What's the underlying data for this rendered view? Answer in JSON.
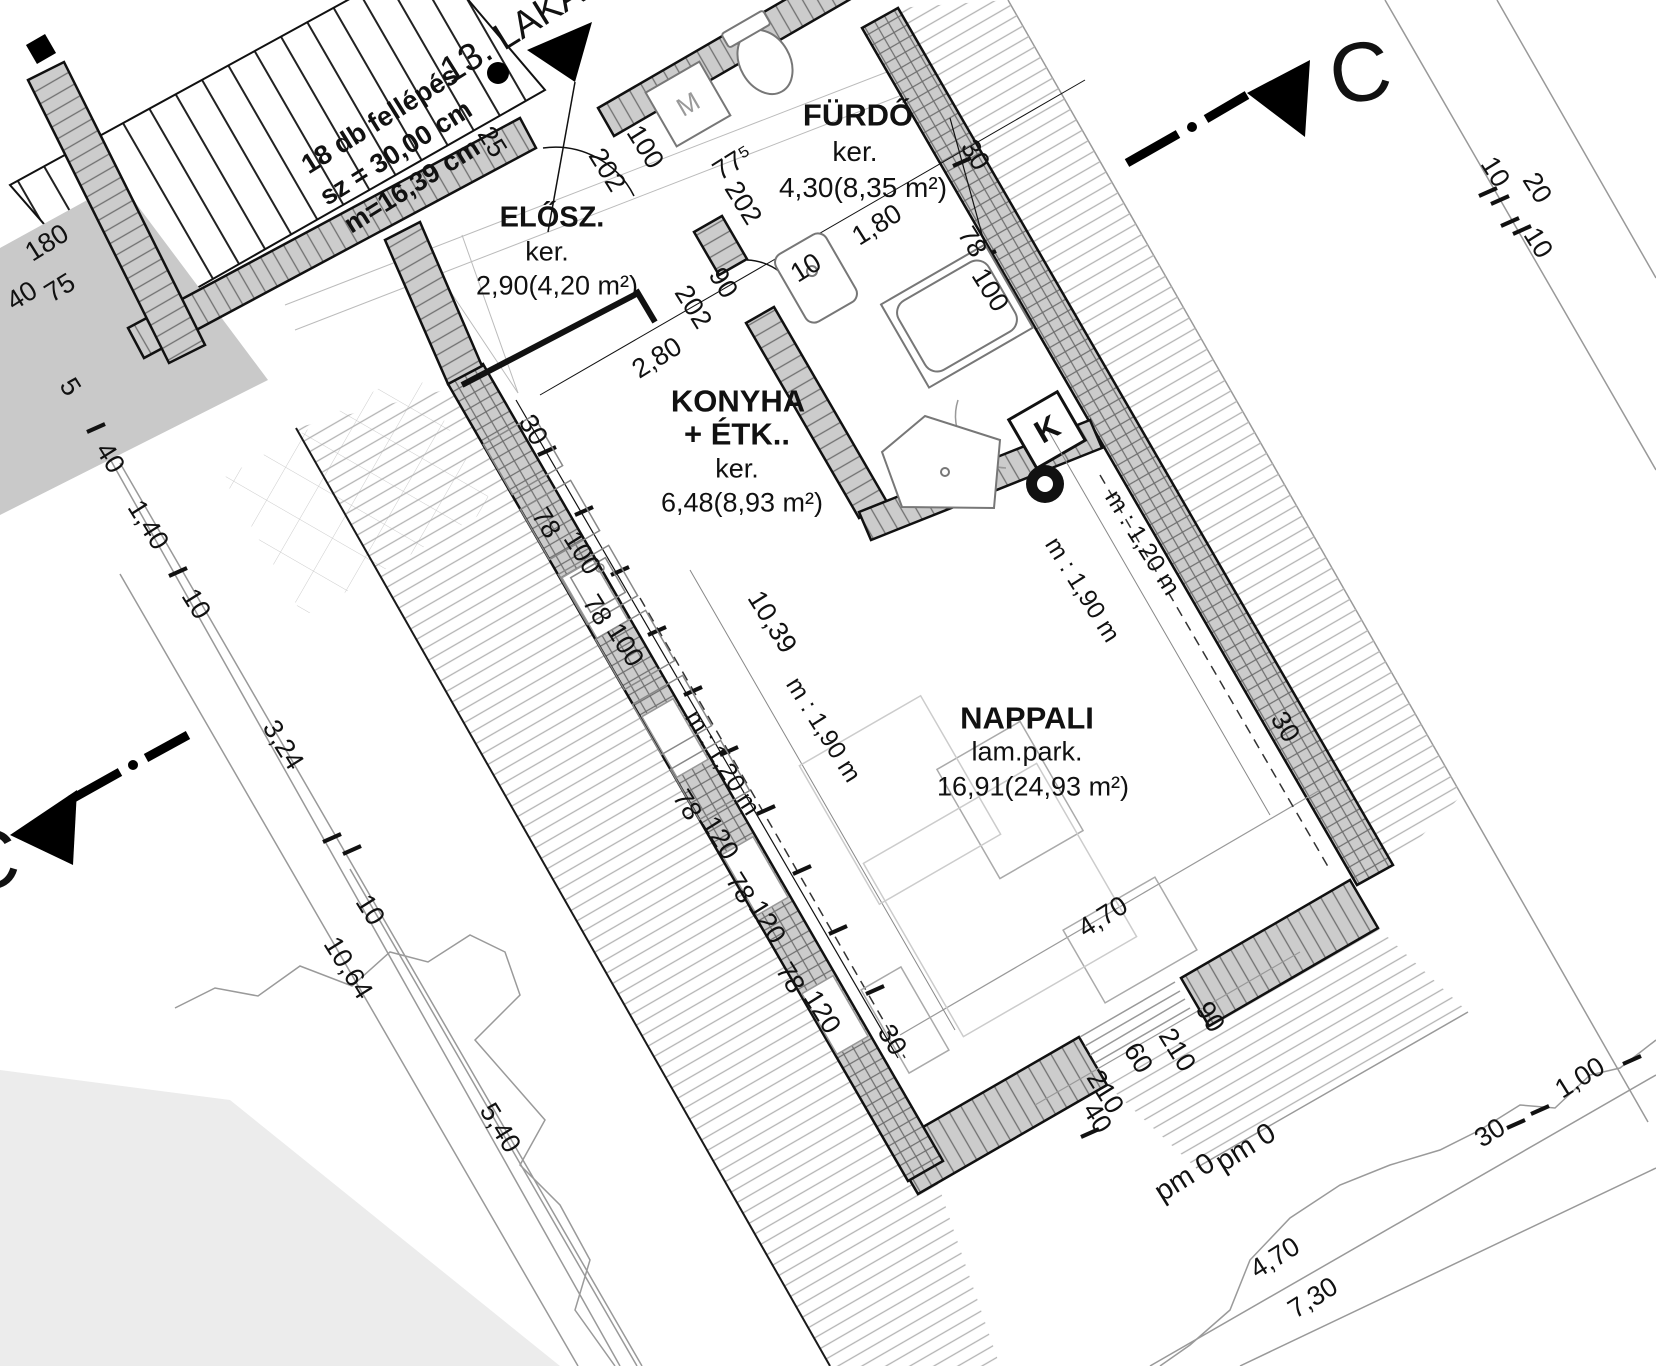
{
  "drawing": {
    "type_note": "attic apartment floor plan",
    "section_letter": "C"
  },
  "labels": {
    "room_labels": [
      {
        "name": "room-fuerdo-title",
        "text": "FÜRDŐ",
        "x": 858,
        "y": 115,
        "rot": 0,
        "size": 31,
        "bold": true
      },
      {
        "name": "room-fuerdo-finish",
        "text": "ker.",
        "x": 855,
        "y": 152,
        "rot": 0,
        "size": 28
      },
      {
        "name": "room-fuerdo-area",
        "text": "4,30(8,35 m²)",
        "x": 863,
        "y": 188,
        "rot": 0,
        "size": 28
      },
      {
        "name": "room-elosz-title",
        "text": "ELŐSZ.",
        "x": 552,
        "y": 218,
        "rot": 0,
        "size": 29,
        "bold": true
      },
      {
        "name": "room-elosz-finish",
        "text": "ker.",
        "x": 547,
        "y": 252,
        "rot": 0,
        "size": 27
      },
      {
        "name": "room-elosz-area",
        "text": "2,90(4,20 m²)",
        "x": 557,
        "y": 286,
        "rot": 0,
        "size": 27
      },
      {
        "name": "room-konyha-title-line1",
        "text": "KONYHA",
        "x": 738,
        "y": 401,
        "rot": 0,
        "size": 31,
        "bold": true
      },
      {
        "name": "room-konyha-title-line2",
        "text": "+ ÉTK..",
        "x": 737,
        "y": 434,
        "rot": 0,
        "size": 31,
        "bold": true
      },
      {
        "name": "room-konyha-finish",
        "text": "ker.",
        "x": 737,
        "y": 469,
        "rot": 0,
        "size": 27
      },
      {
        "name": "room-konyha-area",
        "text": "6,48(8,93 m²)",
        "x": 742,
        "y": 503,
        "rot": 0,
        "size": 27
      },
      {
        "name": "room-nappali-title",
        "text": "NAPPALI",
        "x": 1027,
        "y": 718,
        "rot": 0,
        "size": 31,
        "bold": true
      },
      {
        "name": "room-nappali-finish",
        "text": "lam.park.",
        "x": 1027,
        "y": 752,
        "rot": 0,
        "size": 27
      },
      {
        "name": "room-nappali-area",
        "text": "16,91(24,93 m²)",
        "x": 1033,
        "y": 787,
        "rot": 0,
        "size": 27
      }
    ],
    "annotation_labels": [
      {
        "name": "stair-note-line1",
        "text": "18 db fellépés",
        "x": 380,
        "y": 120,
        "rot": -32,
        "size": 27,
        "bold": true
      },
      {
        "name": "stair-note-line2",
        "text": "sz = 30,00 cm",
        "x": 396,
        "y": 153,
        "rot": -32,
        "size": 27,
        "bold": true
      },
      {
        "name": "stair-note-line3",
        "text": "m=16,39 cm",
        "x": 412,
        "y": 186,
        "rot": -32,
        "size": 27,
        "bold": true
      },
      {
        "name": "apartment-number",
        "text": "13. LAKÁ",
        "x": 512,
        "y": 32,
        "rot": -32,
        "size": 38
      },
      {
        "name": "washing-machine-letter",
        "text": "M",
        "x": 688,
        "y": 104,
        "rot": -30,
        "size": 26,
        "color": "#999999"
      },
      {
        "name": "chimney-letter",
        "text": "K",
        "x": 1047,
        "y": 429,
        "rot": -30,
        "size": 32,
        "bold": true
      },
      {
        "name": "headroom-120-left",
        "text": "m : 1,20 m",
        "x": 722,
        "y": 763,
        "rot": 58,
        "size": 25
      },
      {
        "name": "headroom-190-left",
        "text": "m : 1,90 m",
        "x": 823,
        "y": 730,
        "rot": 58,
        "size": 25
      },
      {
        "name": "headroom-120-right",
        "text": "m : 1,20 m",
        "x": 1142,
        "y": 543,
        "rot": 58,
        "size": 25
      },
      {
        "name": "headroom-190-right",
        "text": "m : 1,90 m",
        "x": 1082,
        "y": 590,
        "rot": 58,
        "size": 25
      },
      {
        "name": "level-mark-a",
        "text": "pm 0",
        "x": 1185,
        "y": 1178,
        "rot": -32,
        "size": 29
      },
      {
        "name": "level-mark-b",
        "text": "pm 0",
        "x": 1246,
        "y": 1148,
        "rot": -32,
        "size": 29
      }
    ],
    "marker_labels": [
      {
        "name": "section-letter-top-right",
        "text": "C",
        "x": 1360,
        "y": 72,
        "rot": -10,
        "size": 84
      },
      {
        "name": "section-letter-bottom-left",
        "text": "C",
        "x": -12,
        "y": 860,
        "rot": -10,
        "size": 84
      }
    ],
    "dimension_labels": [
      {
        "name": "dim-25",
        "text": "25",
        "x": 492,
        "y": 142,
        "rot": 58,
        "size": 27
      },
      {
        "name": "dim-202-a",
        "text": "202",
        "x": 607,
        "y": 170,
        "rot": 58,
        "size": 27
      },
      {
        "name": "dim-100-a",
        "text": "100",
        "x": 645,
        "y": 147,
        "rot": 58,
        "size": 27
      },
      {
        "name": "dim-202-b",
        "text": "202",
        "x": 743,
        "y": 203,
        "rot": 58,
        "size": 27
      },
      {
        "name": "dim-202-c",
        "text": "202",
        "x": 693,
        "y": 307,
        "rot": 58,
        "size": 27
      },
      {
        "name": "dim-90-a",
        "text": "90",
        "x": 723,
        "y": 283,
        "rot": 58,
        "size": 27
      },
      {
        "name": "dim-775",
        "text": "77⁵",
        "x": 733,
        "y": 163,
        "rot": -32,
        "size": 27
      },
      {
        "name": "dim-180-a",
        "text": "1,80",
        "x": 877,
        "y": 225,
        "rot": -32,
        "size": 27
      },
      {
        "name": "dim-10-a",
        "text": "10",
        "x": 806,
        "y": 268,
        "rot": -32,
        "size": 27
      },
      {
        "name": "dim-280",
        "text": "2,80",
        "x": 657,
        "y": 358,
        "rot": -32,
        "size": 27
      },
      {
        "name": "dim-30-a",
        "text": "30",
        "x": 975,
        "y": 155,
        "rot": 58,
        "size": 27
      },
      {
        "name": "dim-78-a",
        "text": "78",
        "x": 972,
        "y": 242,
        "rot": 58,
        "size": 27
      },
      {
        "name": "dim-100-b",
        "text": "100",
        "x": 990,
        "y": 290,
        "rot": 58,
        "size": 27
      },
      {
        "name": "dim-30-b",
        "text": "30",
        "x": 533,
        "y": 430,
        "rot": 58,
        "size": 27
      },
      {
        "name": "dim-78-b",
        "text": "78",
        "x": 546,
        "y": 523,
        "rot": 58,
        "size": 27
      },
      {
        "name": "dim-100-c",
        "text": "100",
        "x": 582,
        "y": 553,
        "rot": 58,
        "size": 27
      },
      {
        "name": "dim-78-c",
        "text": "78",
        "x": 597,
        "y": 610,
        "rot": 58,
        "size": 27
      },
      {
        "name": "dim-100-d",
        "text": "100",
        "x": 625,
        "y": 645,
        "rot": 58,
        "size": 27
      },
      {
        "name": "dim-1039",
        "text": "10,39",
        "x": 772,
        "y": 622,
        "rot": 58,
        "size": 27
      },
      {
        "name": "dim-78-d",
        "text": "78",
        "x": 687,
        "y": 805,
        "rot": 58,
        "size": 27
      },
      {
        "name": "dim-120-a",
        "text": "120",
        "x": 720,
        "y": 838,
        "rot": 58,
        "size": 27
      },
      {
        "name": "dim-78-e",
        "text": "78",
        "x": 740,
        "y": 888,
        "rot": 58,
        "size": 27
      },
      {
        "name": "dim-120-b",
        "text": "120",
        "x": 767,
        "y": 922,
        "rot": 58,
        "size": 27
      },
      {
        "name": "dim-78-f",
        "text": "78",
        "x": 790,
        "y": 978,
        "rot": 58,
        "size": 27
      },
      {
        "name": "dim-120-c",
        "text": "120",
        "x": 822,
        "y": 1012,
        "rot": 58,
        "size": 27
      },
      {
        "name": "dim-30-c",
        "text": "30",
        "x": 892,
        "y": 1040,
        "rot": 58,
        "size": 27
      },
      {
        "name": "dim-30-d",
        "text": "30",
        "x": 1285,
        "y": 727,
        "rot": 58,
        "size": 27
      },
      {
        "name": "dim-470-a",
        "text": "4,70",
        "x": 1103,
        "y": 917,
        "rot": -32,
        "size": 27
      },
      {
        "name": "dim-90-b",
        "text": "90",
        "x": 1210,
        "y": 1017,
        "rot": 58,
        "size": 27
      },
      {
        "name": "dim-210-a",
        "text": "210",
        "x": 1177,
        "y": 1050,
        "rot": 58,
        "size": 27
      },
      {
        "name": "dim-60",
        "text": "60",
        "x": 1138,
        "y": 1058,
        "rot": 58,
        "size": 27
      },
      {
        "name": "dim-210-b",
        "text": "210",
        "x": 1105,
        "y": 1092,
        "rot": 58,
        "size": 27
      },
      {
        "name": "dim-40-a",
        "text": "40",
        "x": 1097,
        "y": 1118,
        "rot": 58,
        "size": 27
      },
      {
        "name": "dim-470-b",
        "text": "4,70",
        "x": 1275,
        "y": 1258,
        "rot": -32,
        "size": 27
      },
      {
        "name": "dim-730",
        "text": "7,30",
        "x": 1313,
        "y": 1298,
        "rot": -32,
        "size": 27
      },
      {
        "name": "dim-30-e",
        "text": "30",
        "x": 1490,
        "y": 1133,
        "rot": -32,
        "size": 27
      },
      {
        "name": "dim-100-e",
        "text": "1,00",
        "x": 1580,
        "y": 1078,
        "rot": -32,
        "size": 27
      },
      {
        "name": "dim-10-b",
        "text": "10",
        "x": 1495,
        "y": 172,
        "rot": 58,
        "size": 27
      },
      {
        "name": "dim-20",
        "text": "20",
        "x": 1537,
        "y": 188,
        "rot": 58,
        "size": 27
      },
      {
        "name": "dim-10-c",
        "text": "10",
        "x": 1538,
        "y": 243,
        "rot": 58,
        "size": 27
      },
      {
        "name": "dim-180-b",
        "text": "180",
        "x": 47,
        "y": 243,
        "rot": -32,
        "size": 27
      },
      {
        "name": "dim-75",
        "text": "75",
        "x": 60,
        "y": 288,
        "rot": -32,
        "size": 27
      },
      {
        "name": "dim-40-b",
        "text": "40",
        "x": 22,
        "y": 296,
        "rot": -32,
        "size": 27
      },
      {
        "name": "dim-5",
        "text": "5",
        "x": 70,
        "y": 387,
        "rot": 58,
        "size": 27
      },
      {
        "name": "dim-40-c",
        "text": "40",
        "x": 110,
        "y": 458,
        "rot": 58,
        "size": 27
      },
      {
        "name": "dim-140",
        "text": "1,40",
        "x": 148,
        "y": 525,
        "rot": 58,
        "size": 27
      },
      {
        "name": "dim-10-d",
        "text": "10",
        "x": 196,
        "y": 604,
        "rot": 58,
        "size": 27
      },
      {
        "name": "dim-324",
        "text": "3,24",
        "x": 283,
        "y": 745,
        "rot": 58,
        "size": 27
      },
      {
        "name": "dim-10-e",
        "text": "10",
        "x": 370,
        "y": 910,
        "rot": 58,
        "size": 27
      },
      {
        "name": "dim-1064",
        "text": "10,64",
        "x": 348,
        "y": 968,
        "rot": 58,
        "size": 27
      },
      {
        "name": "dim-540",
        "text": "5,40",
        "x": 500,
        "y": 1128,
        "rot": 58,
        "size": 27
      }
    ]
  }
}
